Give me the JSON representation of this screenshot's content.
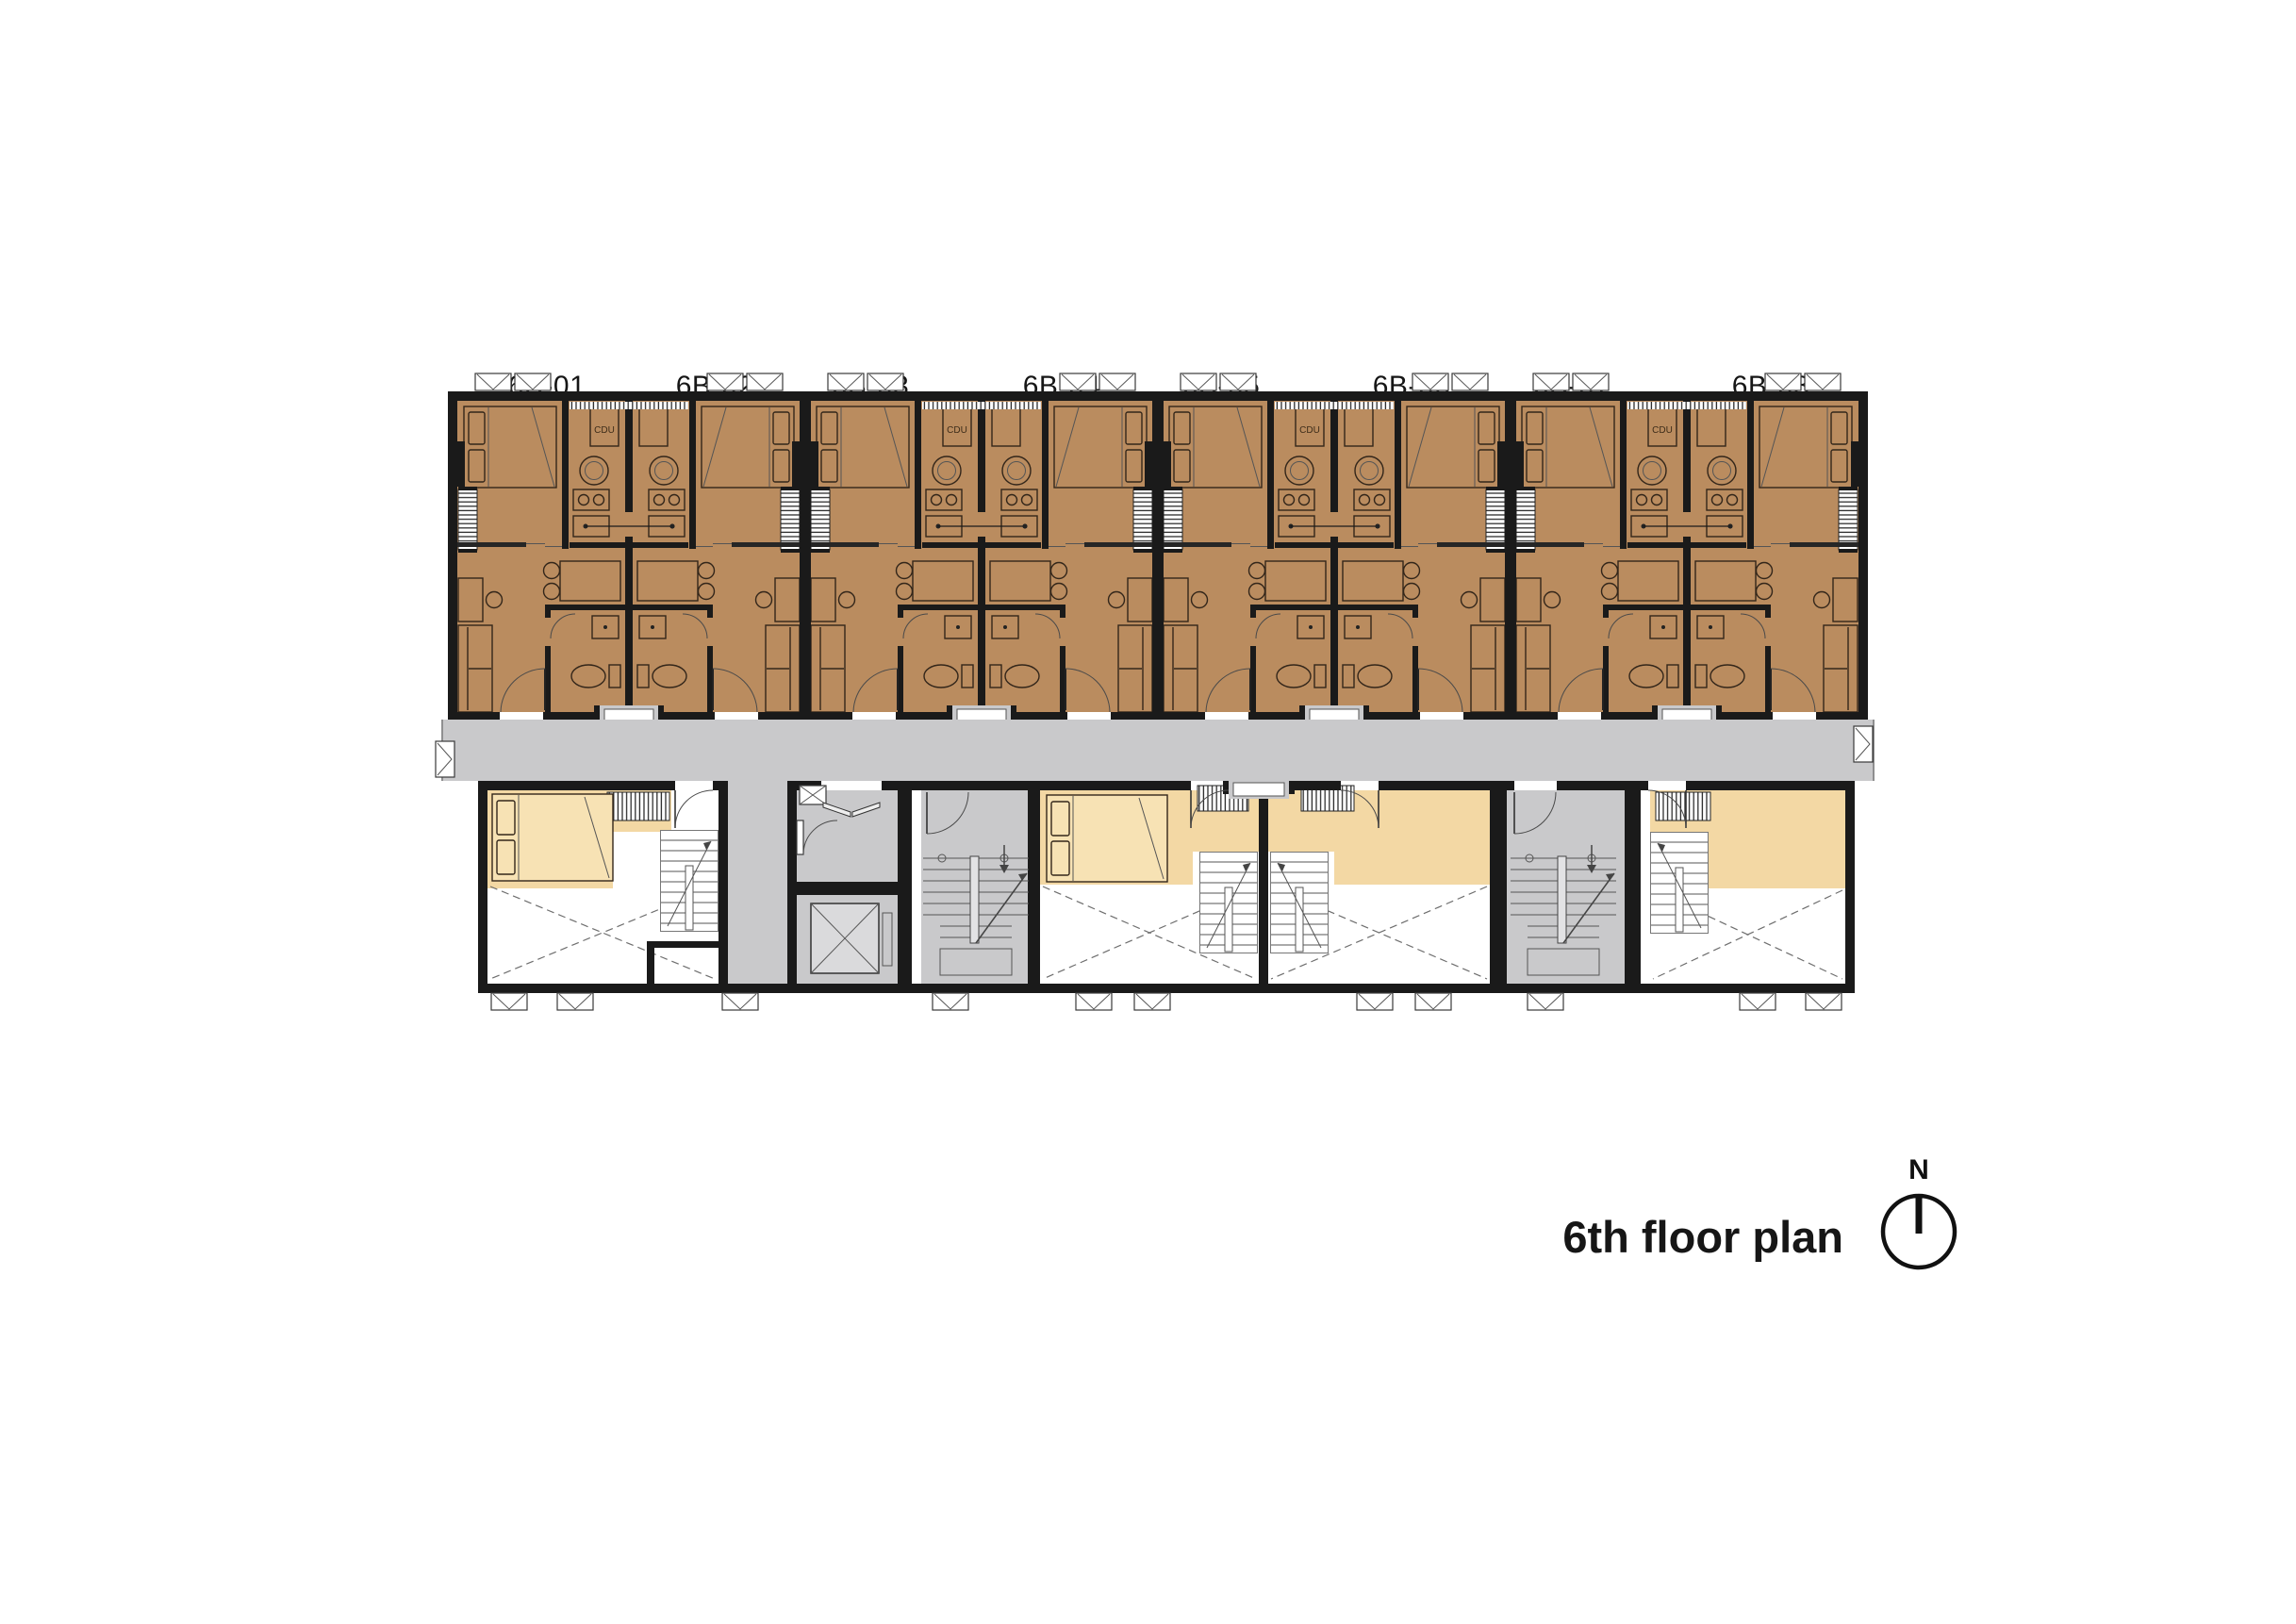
{
  "plan": {
    "units": [
      {
        "id": "6B-01",
        "area": "28.62"
      },
      {
        "id": "6B-02",
        "area": "28.20"
      },
      {
        "id": "6B-03",
        "area": "28.20"
      },
      {
        "id": "6B-04",
        "area": "28.20"
      },
      {
        "id": "6B-05",
        "area": "28.20"
      },
      {
        "id": "6B-06",
        "area": "28.20"
      },
      {
        "id": "6B-07",
        "area": "28.20"
      },
      {
        "id": "6B-08",
        "area": "28.62"
      }
    ],
    "cdu_label": "CDU",
    "colors": {
      "wall": "#1a1a1a",
      "unit": "#BA8C5F",
      "cream": "#F3D8A4",
      "gray": "#C9C9CB",
      "line": "#33261a"
    }
  },
  "footer": {
    "caption": "6th floor plan",
    "north_label": "N"
  }
}
